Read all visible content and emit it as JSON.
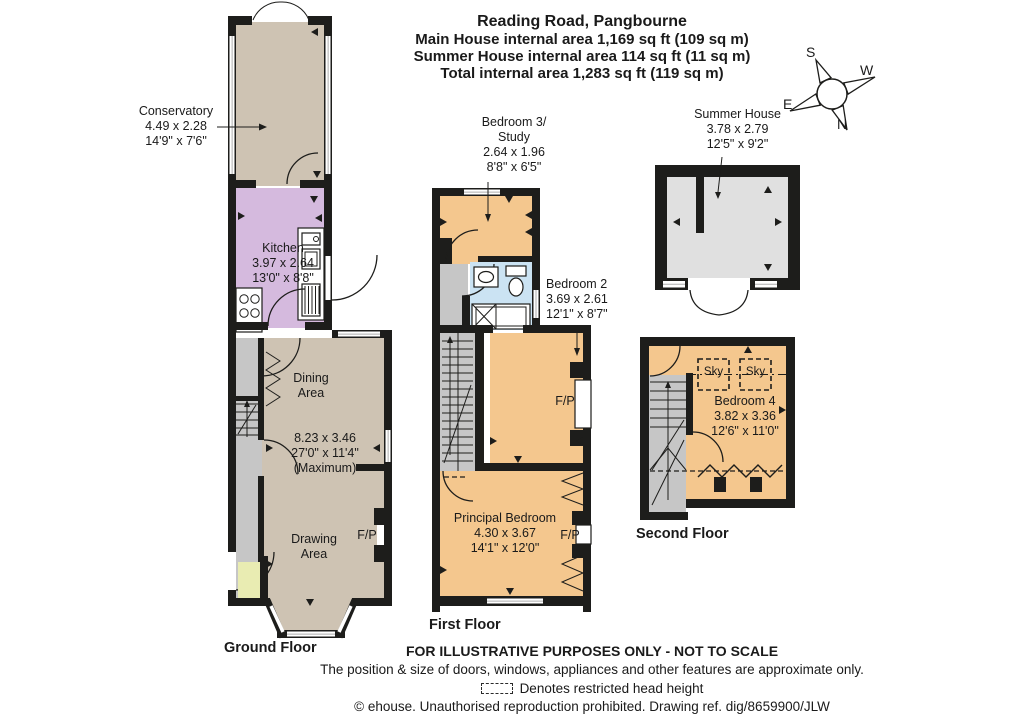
{
  "title": {
    "address": "Reading Road, Pangbourne",
    "main_area": "Main House internal area 1,169 sq ft (109 sq m)",
    "summer_area": "Summer House internal area 114 sq ft (11 sq m)",
    "total_area": "Total internal area 1,283 sq ft (119 sq m)"
  },
  "compass": {
    "north": "N",
    "south": "S",
    "east": "E",
    "west": "W"
  },
  "ground_floor": {
    "label": "Ground Floor",
    "conservatory": {
      "name": "Conservatory",
      "metric": "4.49 x 2.28",
      "imperial": "14'9\" x 7'6\""
    },
    "kitchen": {
      "name": "Kitchen",
      "metric": "3.97 x 2.64",
      "imperial": "13'0\" x 8'8\""
    },
    "dining": {
      "name": "Dining Area"
    },
    "reception": {
      "metric": "8.23 x 3.46",
      "imperial": "27'0\" x 11'4\"",
      "note": "(Maximum)"
    },
    "drawing": {
      "name": "Drawing Area"
    },
    "fireplace": "F/P"
  },
  "first_floor": {
    "label": "First Floor",
    "bedroom3": {
      "name_line1": "Bedroom 3/",
      "name_line2": "Study",
      "metric": "2.64 x 1.96",
      "imperial": "8'8\" x 6'5\""
    },
    "bedroom2": {
      "name": "Bedroom 2",
      "metric": "3.69 x 2.61",
      "imperial": "12'1\" x 8'7\""
    },
    "principal": {
      "name": "Principal Bedroom",
      "metric": "4.30 x 3.67",
      "imperial": "14'1\" x 12'0\""
    },
    "fireplace_bedroom2": "F/P",
    "fireplace_principal": "F/P"
  },
  "second_floor": {
    "label": "Second Floor",
    "bedroom4": {
      "name": "Bedroom 4",
      "metric": "3.82 x 3.36",
      "imperial": "12'6\" x 11'0\""
    },
    "skylight1": "Sky",
    "skylight2": "Sky"
  },
  "summer_house": {
    "name": "Summer House",
    "metric": "3.78 x 2.79",
    "imperial": "12'5\" x 9'2\""
  },
  "footer": {
    "line1": "FOR ILLUSTRATIVE PURPOSES ONLY - NOT TO SCALE",
    "line2": "The position & size of doors, windows, appliances and other features are approximate only.",
    "line3": "Denotes restricted head height",
    "line4": "© ehouse. Unauthorised reproduction prohibited. Drawing ref. dig/8659900/JLW"
  },
  "colors": {
    "wall": "#1d1d1b",
    "room_tan": "#cec3b3",
    "kitchen_purple": "#d5bade",
    "bedroom_orange": "#f4c78e",
    "bathroom_blue": "#cbe3f3",
    "hallway_gray": "#c6c6c6",
    "summer_gray": "#e0e0e0",
    "porch_green": "#e9ecb2",
    "window_line": "#9a9a9a"
  }
}
